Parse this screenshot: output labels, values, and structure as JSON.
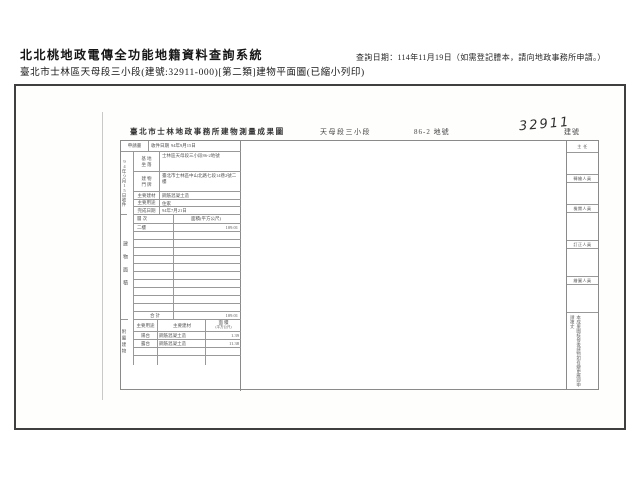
{
  "header": {
    "system_title": "北北桃地政電傳全功能地籍資料查詢系統",
    "query_date": "查詢日期：114年11月19日（如需登記謄本，請向地政事務所申請。）",
    "subtitle": "臺北市士林區天母段三小段(建號:32911-000)[第二類]建物平面圖(已縮小列印)"
  },
  "form": {
    "title": "臺北市士林地政事務所建物測量成果圖",
    "section": "天母段三小段",
    "parcel_no": "86-2",
    "parcel_suffix": "地號",
    "building_no": "32911",
    "building_no_suffix": "建號",
    "location_scale": "位置圖 比例尺 1:500",
    "plan_scale": "平面圖 比例尺 1:250",
    "page_info": "共1頁 第1頁",
    "apply_label": "申請書",
    "receive_label": "收件日期",
    "receive_date": "94年9月15日",
    "receive_vertical": "94年9月15日收件",
    "section_floor_vertical": "建物面積",
    "section_annex_vertical": "附屬建物",
    "site_label_a": "基 地",
    "site_label_b": "坐 落",
    "site_value": "士林區天母段三小段86-2地號",
    "door_label_a": "建 物",
    "door_label_b": "門 牌",
    "door_value": "臺北市士林區中山北路七段14巷2號二樓",
    "material_label": "主要建材",
    "material_value": "鋼筋混凝土造",
    "usage_label": "主要用途",
    "usage_value": "住家",
    "complete_label": "完成日期",
    "complete_value": "94年7月21日",
    "floor_table": {
      "col_floor": "層 次",
      "col_area": "面積(平方公尺)",
      "rows": [
        {
          "floor": "二樓",
          "area": "109.01"
        }
      ],
      "total_label": "合 計",
      "total_value": "109.01"
    },
    "annex_table": {
      "col_use": "主要用途",
      "col_material": "主要建材",
      "col_area_a": "面 積",
      "col_area_b": "(平方公尺)",
      "rows": [
        {
          "use": "陽台",
          "material": "鋼筋混凝土造",
          "area": "1.39"
        },
        {
          "use": "露台",
          "material": "鋼筋混凝土造",
          "area": "11.38"
        }
      ]
    },
    "calc": {
      "line1": "二樓：109.01=109.01",
      "line2": "圖示：(1*0.44)+(2*0.4)+1.34+(3.03+0.44)*(1.63+1.10)+(0.50*0.3)+(3.19)+(0.71*0.64*0.5)+(3.66*1.36)+",
      "line3": "(2.72*0.24)*2.40+0.72*0.64*0.5+2.60*1.43*1.65"
    },
    "site_plan": {
      "parcel_label": "86-2",
      "adjacent_label": "86"
    },
    "floor_plan": {
      "center_label": "二樓",
      "balcony_label_1": "陽台",
      "balcony_label_2": "陽台"
    },
    "notes": {
      "line1": "一、本建物平面圖實地測量屬實。",
      "line2": "二、本成果圖依使用執照竣工平面圖轉繪。",
      "line3": "三、依使用執照竣工平面圖轉繪之建物平面圖及位置圖，不涉及實質測繪行為，如有錯誤致生損害者由申請人負責(94北市地測字第0711號函辦理)。",
      "line4": "四、本建物位置圖係依地籍圖轉繪。",
      "stamp": "建物位置略圖"
    },
    "right_panel": {
      "top_label": "主 任",
      "officer_1": "轉繪人員",
      "officer_2": "檢閱人員",
      "officer_3": "訂正人員",
      "officer_4": "繪圖人員",
      "bottom_note": "本成果圖核發後建物如有變更應即申請複丈"
    }
  }
}
